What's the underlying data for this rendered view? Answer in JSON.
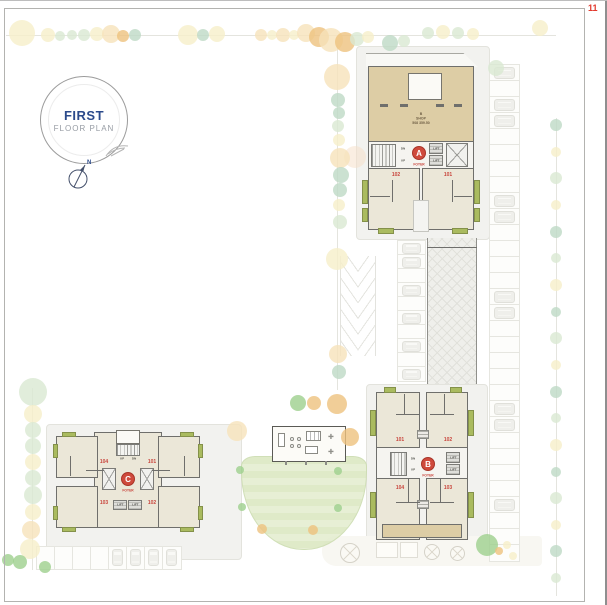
{
  "page": {
    "number": "11"
  },
  "stamp": {
    "title": "FIRST",
    "subtitle": "FLOOR PLAN"
  },
  "compass": {
    "north": "N"
  },
  "palette": {
    "accent_red": "#cf4a3c",
    "unit_label_red": "#c9463d",
    "shop_tan": "#ddcda5",
    "unit_cream": "#ebe7d8",
    "balcony_green": "#aabb5f",
    "lawn_green": "#dce8c3",
    "stamp_blue": "#2b4a8b",
    "page_number_red": "#e23a2e"
  },
  "building_a": {
    "shop": {
      "line1": "B",
      "line2": "SHOP",
      "line3": "508 359.50"
    },
    "core": {
      "letter": "A",
      "foyer": "FOYER",
      "lift_top": "LIFT",
      "lift_bottom": "LIFT",
      "dn": "DN",
      "up": "UP"
    },
    "units": [
      {
        "label": "102"
      },
      {
        "label": "101"
      }
    ]
  },
  "building_b": {
    "core": {
      "letter": "B",
      "foyer": "FOYER",
      "lift_top": "LIFT",
      "lift_bottom": "LIFT",
      "dn": "DN",
      "up": "UP"
    },
    "units": [
      {
        "label": "101"
      },
      {
        "label": "102"
      },
      {
        "label": "104"
      },
      {
        "label": "103"
      }
    ]
  },
  "building_c": {
    "core": {
      "letter": "C",
      "foyer": "FOYER",
      "lift_left": "LIFT",
      "lift_right": "LIFT",
      "up": "UP",
      "dn": "DN"
    },
    "units": [
      {
        "label": "104"
      },
      {
        "label": "101"
      },
      {
        "label": "103"
      },
      {
        "label": "102"
      }
    ]
  }
}
